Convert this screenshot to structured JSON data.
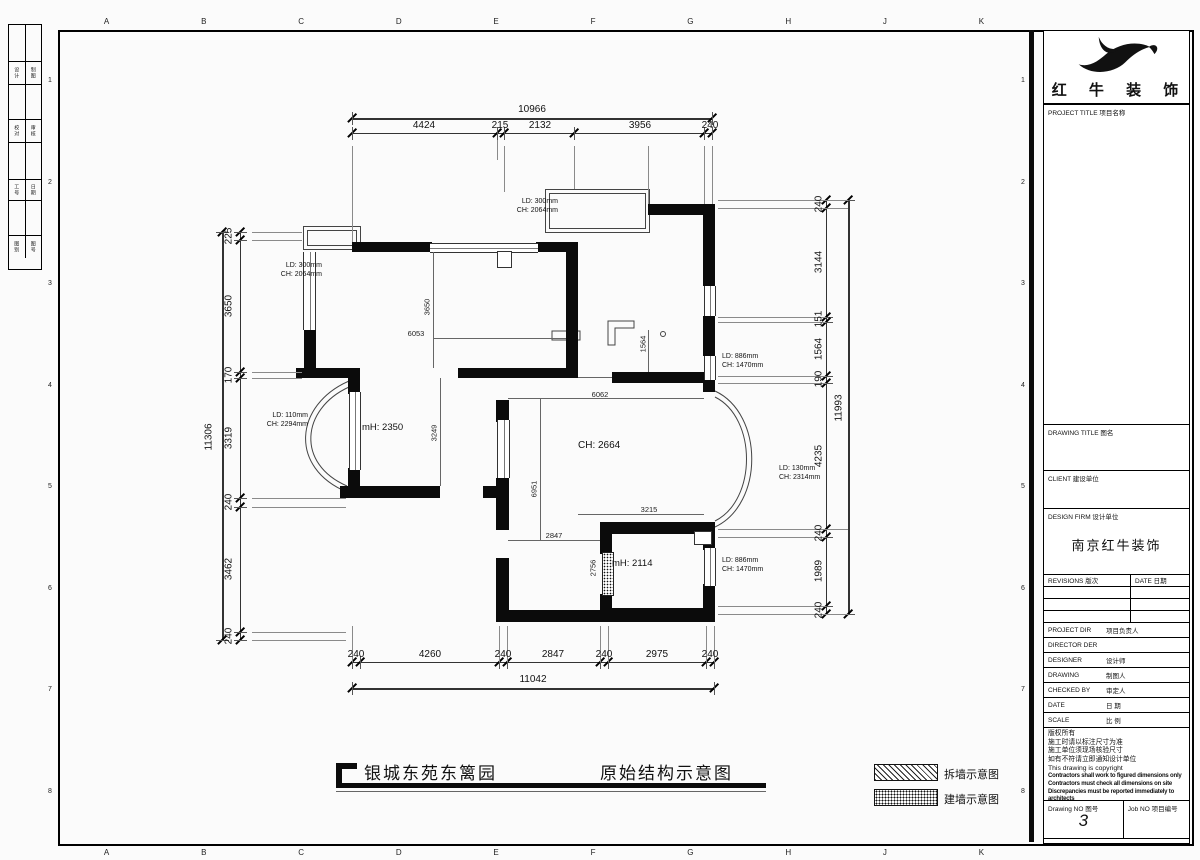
{
  "sheet": {
    "grid_letters": [
      "A",
      "B",
      "C",
      "D",
      "E",
      "F",
      "G",
      "H",
      "J",
      "K"
    ],
    "grid_numbers": [
      "1",
      "2",
      "3",
      "4",
      "5",
      "6",
      "7",
      "8"
    ],
    "edge_strip_rows": [
      {
        "a": "设计",
        "b": "制图"
      },
      {
        "a": "校对",
        "b": "审核"
      },
      {
        "a": "工号",
        "b": "日期"
      },
      {
        "a": "图别",
        "b": "图号"
      }
    ]
  },
  "titles": {
    "project": "银城东苑东篱园",
    "drawing": "原始结构示意图"
  },
  "legend": {
    "demolish": "拆墙示意图",
    "build": "建墙示意图"
  },
  "dims": {
    "top": {
      "total": "10966",
      "segments": [
        "4424",
        "215",
        "2132",
        "3956",
        "240"
      ]
    },
    "bottom": {
      "total": "11042",
      "segments": [
        "240",
        "4260",
        "240",
        "2847",
        "240",
        "2975",
        "240"
      ]
    },
    "left": {
      "total": "11306",
      "segments": [
        "225",
        "3650",
        "170",
        "3319",
        "240",
        "3462",
        "240"
      ]
    },
    "right": {
      "total": "11993",
      "segments": [
        "240",
        "3144",
        "151",
        "1564",
        "190",
        "4235",
        "240",
        "1989",
        "240"
      ]
    },
    "interior": {
      "d3650": "3650",
      "d6053": "6053",
      "d3249": "3249",
      "d1564": "1564",
      "d6062": "6062",
      "d6951": "6951",
      "d2847": "2847",
      "d3215": "3215",
      "d2756": "2756"
    }
  },
  "plan": {
    "rooms": [
      {
        "label": "mH: 2350"
      },
      {
        "label": "CH: 2664"
      },
      {
        "label": "mH: 2114"
      }
    ],
    "openings": [
      {
        "l1": "LD: 300mm",
        "l2": "CH: 2064mm"
      },
      {
        "l1": "LD: 300mm",
        "l2": "CH: 2064mm"
      },
      {
        "l1": "LD: 110mm",
        "l2": "CH: 2294mm"
      },
      {
        "l1": "LD: 886mm",
        "l2": "CH: 1470mm"
      },
      {
        "l1": "LD: 130mm",
        "l2": "CH: 2314mm"
      },
      {
        "l1": "LD: 886mm",
        "l2": "CH: 1470mm"
      }
    ]
  },
  "title_block": {
    "brand": "红 牛 装 饰",
    "project_title_label": "PROJECT TITLE 项目名称",
    "drawing_title_label": "DRAWING TITLE 图名",
    "client_label": "CLIENT 建设单位",
    "design_firm_label": "DESIGN FIRM 设计单位",
    "design_firm_value": "南京红牛装饰",
    "revisions_label": "REVISIONS 版次",
    "date_col_label": "DATE 日期",
    "rows": [
      {
        "en": "PROJECT DIR",
        "cn": "项目负责人"
      },
      {
        "en": "DIRECTOR DER",
        "cn": ""
      },
      {
        "en": "DESIGNER",
        "cn": "设计师"
      },
      {
        "en": "DRAWING",
        "cn": "制图人"
      },
      {
        "en": "CHECKED BY",
        "cn": "审定人"
      },
      {
        "en": "DATE",
        "cn": "日 期"
      },
      {
        "en": "SCALE",
        "cn": "比 例"
      }
    ],
    "notes": [
      "版权所有",
      "施工时请以标注尺寸为准",
      "施工单位须现场核验尺寸",
      "如有不符请立即通知设计单位",
      "This drawing is copyright"
    ],
    "notes_bold": [
      "Contractors shall work to figured dimensions only",
      "Contractors must check all dimensions on site",
      "Discrepancies must be reported immediately to architects"
    ],
    "drawing_no_label": "Drawing NO 图号",
    "drawing_no_value": "3",
    "job_no_label": "Job NO 项目编号"
  }
}
